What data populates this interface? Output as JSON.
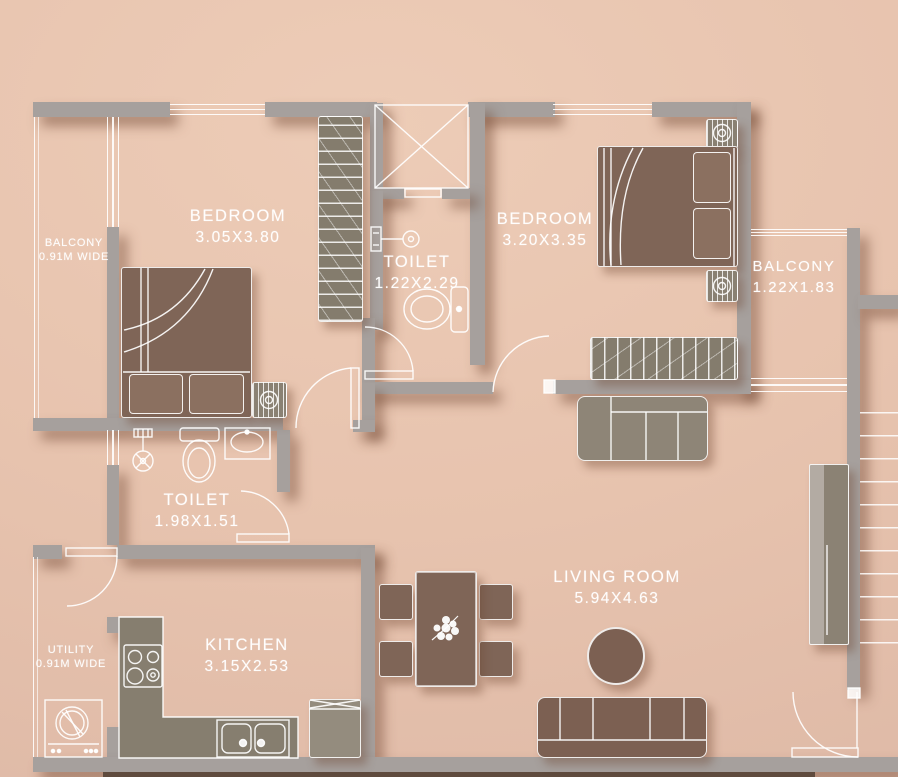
{
  "labels": {
    "bedroom1": {
      "name": "BEDROOM",
      "dims": "3.05X3.80"
    },
    "toilet1": {
      "name": "TOILET",
      "dims": "1.22X2.29"
    },
    "bedroom2": {
      "name": "BEDROOM",
      "dims": "3.20X3.35"
    },
    "balconyLeft": {
      "name": "BALCONY",
      "dims": "0.91M WIDE"
    },
    "balconyRight": {
      "name": "BALCONY",
      "dims": "1.22X1.83"
    },
    "toilet2": {
      "name": "TOILET",
      "dims": "1.98X1.51"
    },
    "living": {
      "name": "LIVING ROOM",
      "dims": "5.94X4.63"
    },
    "kitchen": {
      "name": "KITCHEN",
      "dims": "3.15X2.53"
    },
    "utility": {
      "name": "UTILITY",
      "dims": "0.91M WIDE"
    }
  },
  "palette": {
    "background": "#e7c3ae",
    "wall": "#a6a09d",
    "line": "#ffffff",
    "furniture_wood": "#7f6557",
    "furniture_upholstery": "#8e8577",
    "label_text": "#ffffff"
  }
}
